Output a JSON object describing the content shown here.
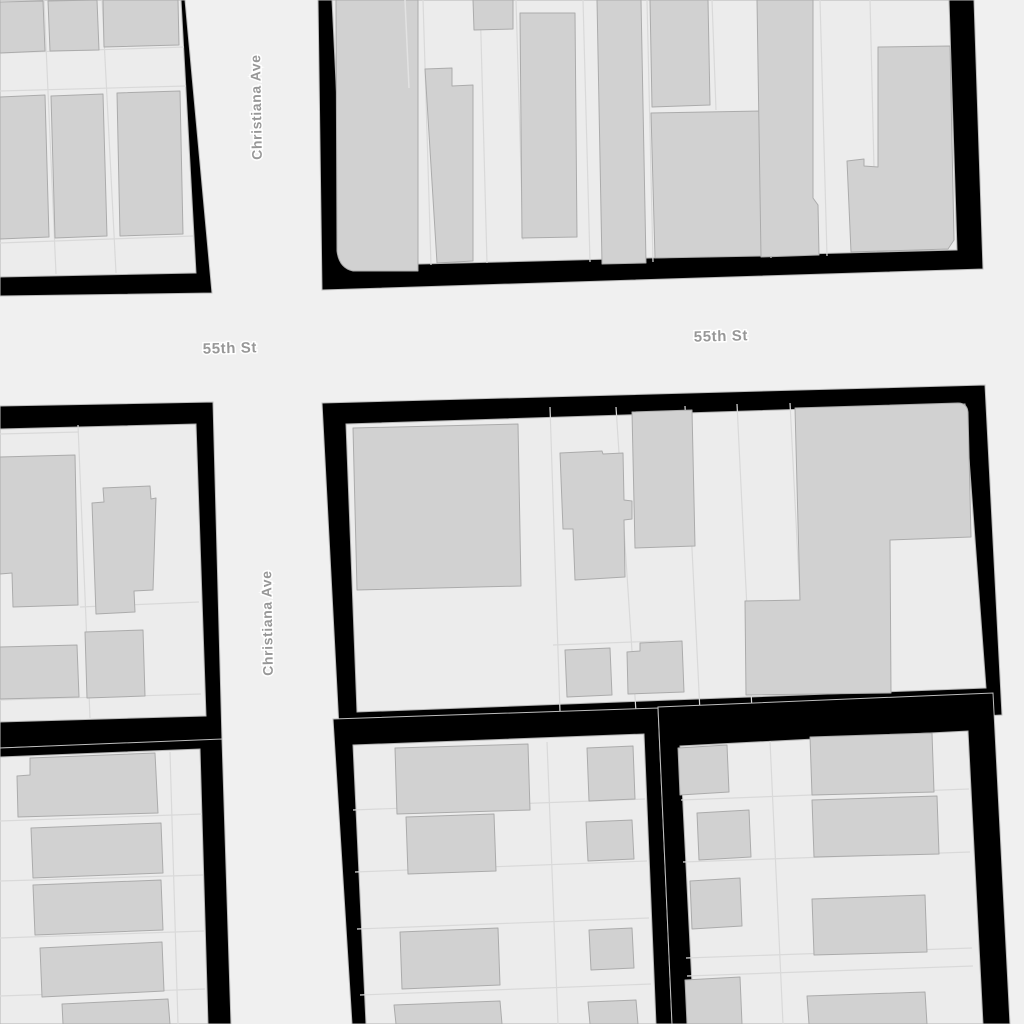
{
  "map": {
    "street_labels": [
      {
        "text": "55th St",
        "x": 230,
        "y": 353,
        "rotate": -1.5,
        "size": 15
      },
      {
        "text": "55th St",
        "x": 721,
        "y": 341,
        "rotate": -1.5,
        "size": 15
      },
      {
        "text": "Christiana Ave",
        "x": 261,
        "y": 107,
        "rotate": -91,
        "size": 14
      },
      {
        "text": "Christiana Ave",
        "x": 272,
        "y": 623,
        "rotate": -91,
        "size": 14
      }
    ],
    "streets": [
      "55th St",
      "Christiana Ave"
    ],
    "theme": {
      "street_bg": "#f0f0f0",
      "parcel_fill": "#ececec",
      "parcel_edge": "#b5b5b5",
      "parcel_line": "#d9d9d9",
      "building_fill": "#d1d1d1",
      "building_stroke": "#ababab",
      "block_color": "#000000",
      "casing": "#bdbdbd",
      "label_color": "#979797",
      "label_halo": "#ffffff"
    }
  }
}
